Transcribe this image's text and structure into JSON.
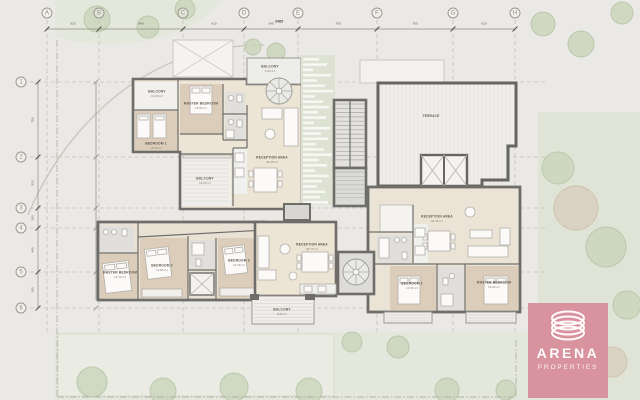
{
  "meta": {
    "drawing_type": "apartment floor plan"
  },
  "colors": {
    "background": "#eae9e5",
    "wall": "#6e6d6a",
    "bedroom_floor": "#dccdba",
    "reception_floor": "#ece4d5",
    "bath_floor": "#e1dfdb",
    "balcony_floor": "#f0efec",
    "green": "#dfe4d6",
    "tree_green": "#ccd6bd",
    "tree_tan": "#d9d0c0",
    "logo_pink": "#d9939e"
  },
  "grid": {
    "columns": [
      {
        "label": "A",
        "x": 47
      },
      {
        "label": "B",
        "x": 99
      },
      {
        "label": "C",
        "x": 183
      },
      {
        "label": "D",
        "x": 244
      },
      {
        "label": "E",
        "x": 298
      },
      {
        "label": "F",
        "x": 377
      },
      {
        "label": "G",
        "x": 453
      },
      {
        "label": "H",
        "x": 515
      }
    ],
    "rows": [
      {
        "label": "1",
        "y": 82
      },
      {
        "label": "2",
        "y": 157
      },
      {
        "label": "3",
        "y": 208
      },
      {
        "label": "4",
        "y": 228
      },
      {
        "label": "5",
        "y": 272
      },
      {
        "label": "6",
        "y": 308
      }
    ]
  },
  "dimensions": {
    "top_total": "3485",
    "top_segments": [
      "520",
      "840",
      "610",
      "540",
      "790",
      "760",
      "620"
    ],
    "left_segments": [
      "750",
      "510",
      "200",
      "440",
      "360"
    ]
  },
  "rooms": [
    {
      "id": "balcony-tl",
      "label": "BALCONY",
      "area": "10.40 m²",
      "x": 157,
      "y": 94
    },
    {
      "id": "master-bedroom-a",
      "label": "MASTER BEDROOM",
      "area": "15.80 m²",
      "x": 201,
      "y": 106
    },
    {
      "id": "bedroom-a1",
      "label": "BEDROOM 1",
      "area": "13.20 m²",
      "x": 156,
      "y": 146
    },
    {
      "id": "balcony-a2",
      "label": "BALCONY",
      "area": "18.60 m²",
      "x": 205,
      "y": 181
    },
    {
      "id": "reception-a",
      "label": "RECEPTION AREA",
      "area": "28.40 m²",
      "x": 272,
      "y": 160
    },
    {
      "id": "balcony-spiral",
      "label": "BALCONY",
      "area": "8.20 m²",
      "x": 270,
      "y": 69
    },
    {
      "id": "terrace",
      "label": "TERRACE",
      "area": "",
      "x": 431,
      "y": 117
    },
    {
      "id": "reception-b",
      "label": "RECEPTION AREA",
      "area": "30.10 m²",
      "x": 437,
      "y": 219
    },
    {
      "id": "bedroom-b1",
      "label": "BEDROOM 1",
      "area": "12.60 m²",
      "x": 412,
      "y": 286
    },
    {
      "id": "master-bedroom-b",
      "label": "MASTER BEDROOM",
      "area": "14.90 m²",
      "x": 494,
      "y": 285
    },
    {
      "id": "reception-c",
      "label": "RECEPTION AREA",
      "area": "26.70 m²",
      "x": 312,
      "y": 247
    },
    {
      "id": "balcony-c",
      "label": "BALCONY",
      "area": "9.60 m²",
      "x": 282,
      "y": 312
    },
    {
      "id": "master-bedroom-c",
      "label": "MASTER BEDROOM",
      "area": "14.20 m²",
      "x": 120,
      "y": 275
    },
    {
      "id": "bedroom-c2",
      "label": "BEDROOM 2",
      "area": "12.80 m²",
      "x": 162,
      "y": 268
    },
    {
      "id": "bedroom-c3",
      "label": "BEDROOM 3",
      "area": "12.40 m²",
      "x": 239,
      "y": 263
    }
  ],
  "landscape": {
    "trees": [
      {
        "x": 97,
        "y": 19,
        "r": 13,
        "t": 0
      },
      {
        "x": 148,
        "y": 27,
        "r": 11,
        "t": 0
      },
      {
        "x": 185,
        "y": 9,
        "r": 10,
        "t": 0
      },
      {
        "x": 253,
        "y": 47,
        "r": 8,
        "t": 0
      },
      {
        "x": 276,
        "y": 52,
        "r": 9,
        "t": 0
      },
      {
        "x": 543,
        "y": 24,
        "r": 12,
        "t": 0
      },
      {
        "x": 581,
        "y": 44,
        "r": 13,
        "t": 0
      },
      {
        "x": 622,
        "y": 13,
        "r": 11,
        "t": 0
      },
      {
        "x": 558,
        "y": 168,
        "r": 16,
        "t": 0
      },
      {
        "x": 576,
        "y": 208,
        "r": 22,
        "t": 1
      },
      {
        "x": 606,
        "y": 247,
        "r": 20,
        "t": 0
      },
      {
        "x": 566,
        "y": 331,
        "r": 18,
        "t": 0
      },
      {
        "x": 627,
        "y": 305,
        "r": 14,
        "t": 0
      },
      {
        "x": 612,
        "y": 362,
        "r": 15,
        "t": 1
      },
      {
        "x": 92,
        "y": 382,
        "r": 15,
        "t": 0
      },
      {
        "x": 163,
        "y": 391,
        "r": 13,
        "t": 0
      },
      {
        "x": 234,
        "y": 387,
        "r": 14,
        "t": 0
      },
      {
        "x": 309,
        "y": 391,
        "r": 13,
        "t": 0
      },
      {
        "x": 352,
        "y": 342,
        "r": 10,
        "t": 0
      },
      {
        "x": 398,
        "y": 347,
        "r": 11,
        "t": 0
      },
      {
        "x": 447,
        "y": 390,
        "r": 12,
        "t": 0
      },
      {
        "x": 506,
        "y": 390,
        "r": 10,
        "t": 0
      }
    ],
    "louver_widths": [
      16,
      24,
      10,
      28,
      14,
      22,
      30,
      12,
      20,
      26,
      15,
      23,
      11,
      27,
      18,
      25,
      13,
      21,
      29,
      16,
      24,
      12,
      26,
      19,
      14,
      22,
      17,
      25
    ]
  },
  "logo": {
    "brand": "ARENA",
    "sub": "PROPERTIES"
  }
}
